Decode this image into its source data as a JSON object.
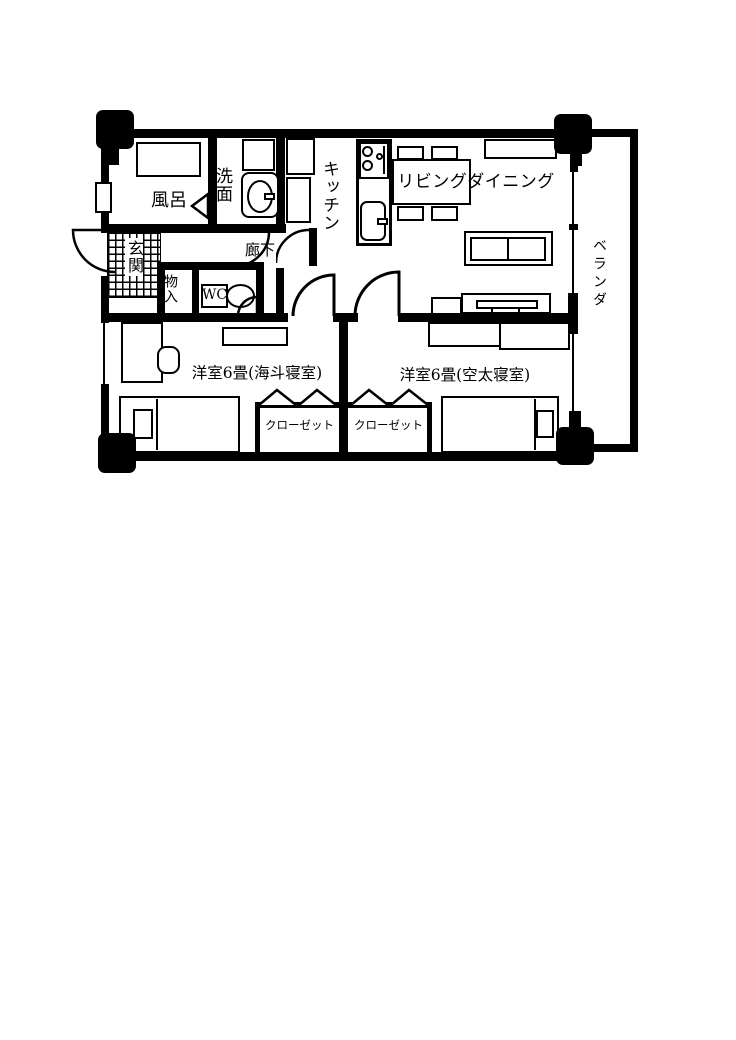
{
  "plan": {
    "colors": {
      "wall": "#000000",
      "background": "#ffffff"
    },
    "rooms": {
      "bath": {
        "label": "風呂"
      },
      "washroom": {
        "label": "洗面"
      },
      "kitchen": {
        "label": "キッチン"
      },
      "living": {
        "label": "リビングダイニング"
      },
      "entrance": {
        "label": "玄関"
      },
      "hallway": {
        "label": "廊下"
      },
      "storage": {
        "label": "物入"
      },
      "wc": {
        "label": "WC"
      },
      "veranda": {
        "label": "ベランダ"
      },
      "bedroom_left": {
        "label": "洋室6畳(海斗寝室)"
      },
      "bedroom_right": {
        "label": "洋室6畳(空太寝室)"
      },
      "closet_left": {
        "label": "クローゼット"
      },
      "closet_right": {
        "label": "クローゼット"
      }
    }
  }
}
